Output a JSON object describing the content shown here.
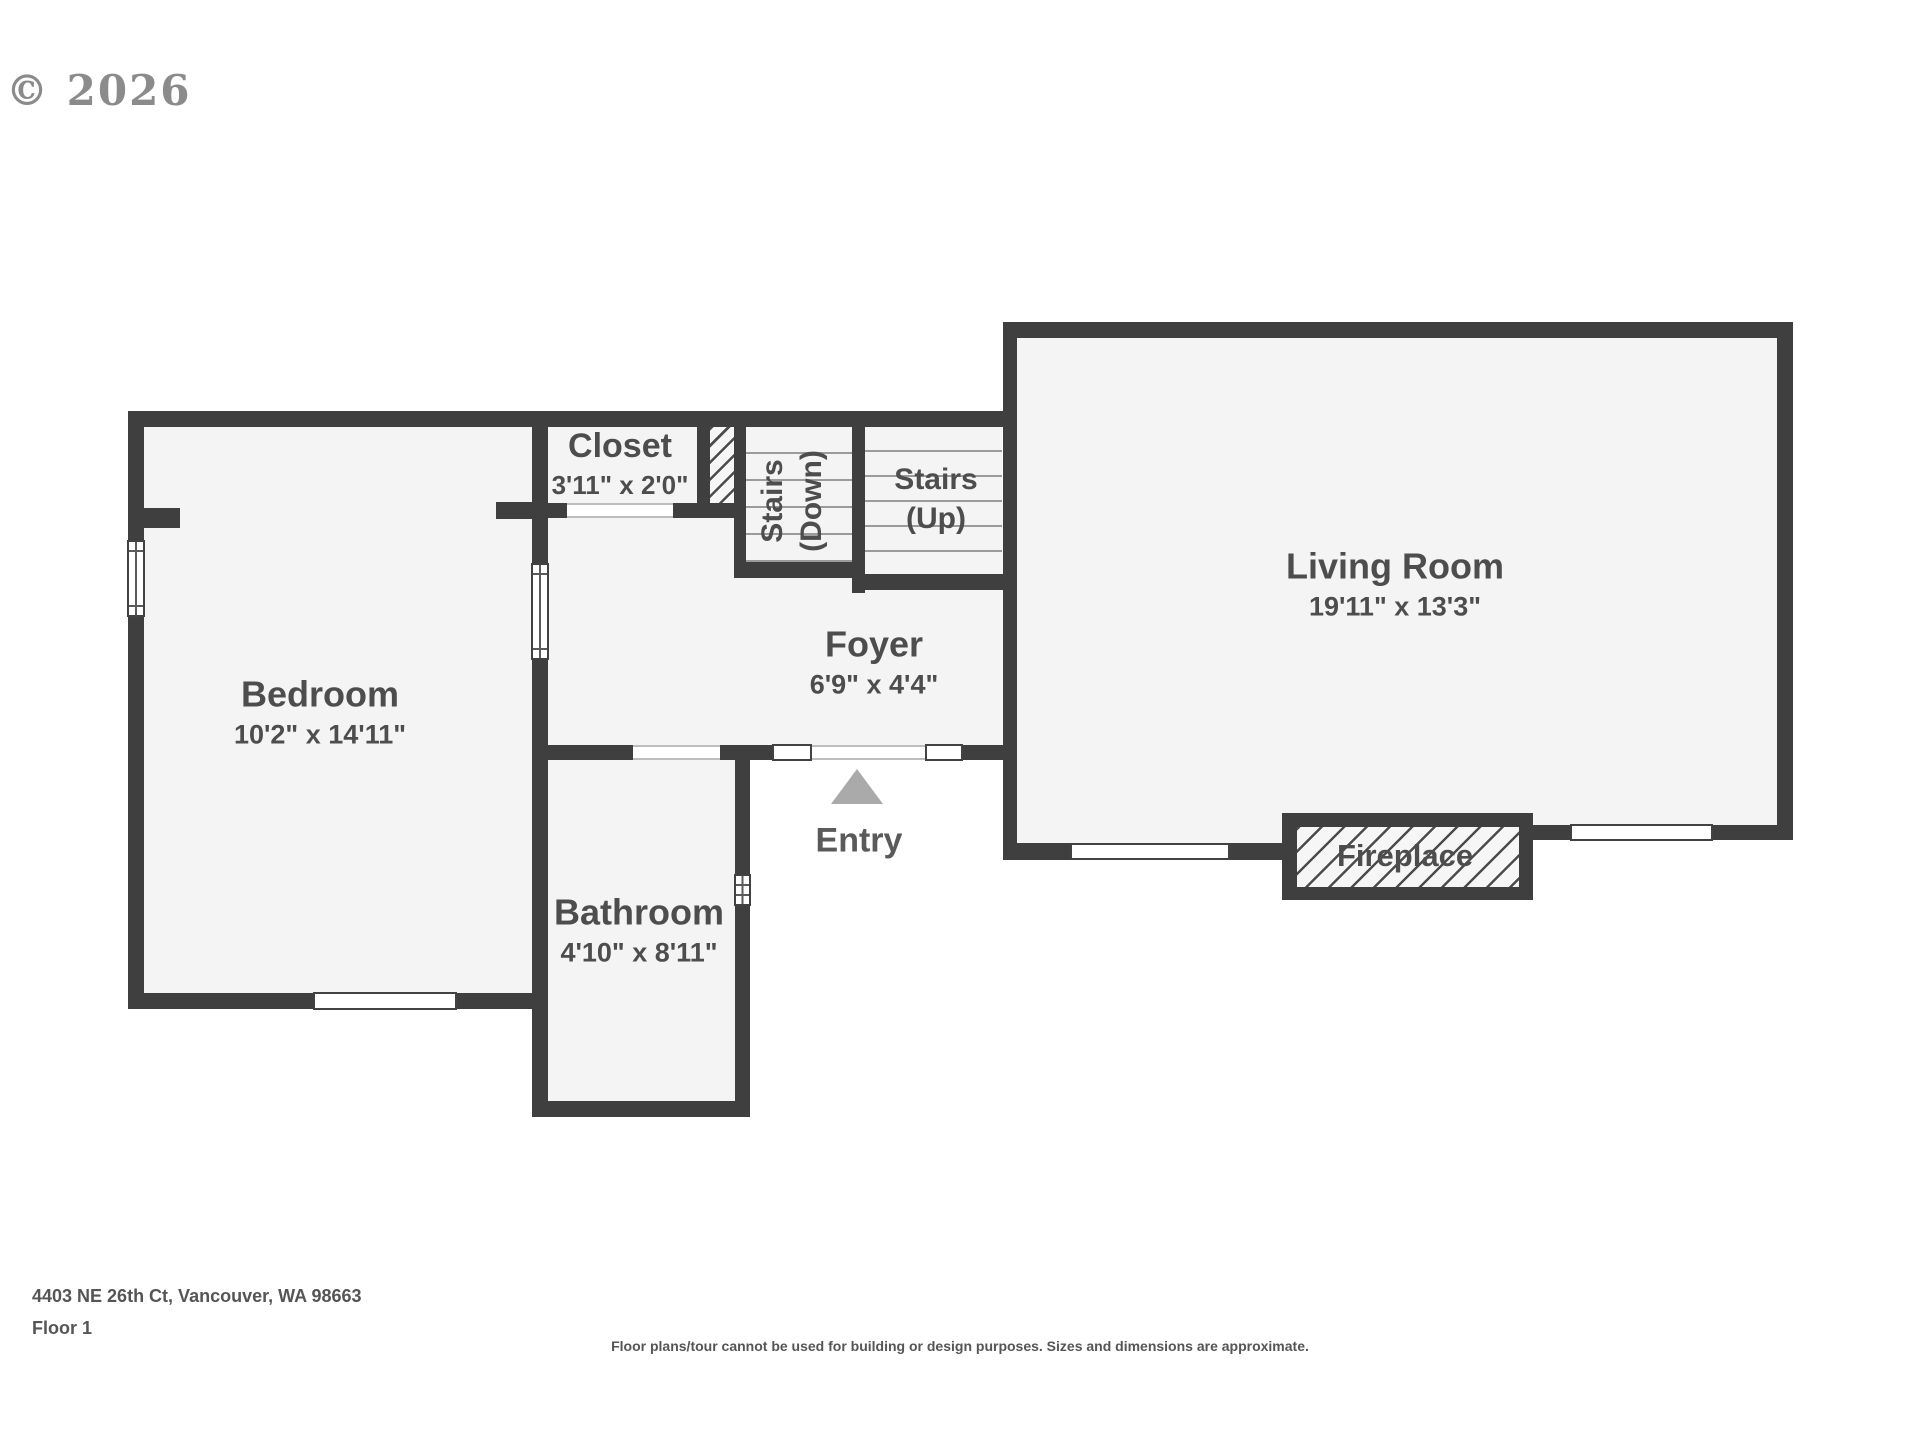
{
  "copyright": "© 2026",
  "rooms": {
    "bedroom": {
      "name": "Bedroom",
      "dims": "10'2\" x 14'11\""
    },
    "closet": {
      "name": "Closet",
      "dims": "3'11\" x 2'0\""
    },
    "stairs_down": {
      "line1": "Stairs",
      "line2": "(Down)"
    },
    "stairs_up": {
      "line1": "Stairs",
      "line2": "(Up)"
    },
    "foyer": {
      "name": "Foyer",
      "dims": "6'9\" x 4'4\""
    },
    "living_room": {
      "name": "Living Room",
      "dims": "19'11\" x 13'3\""
    },
    "bathroom": {
      "name": "Bathroom",
      "dims": "4'10\" x 8'11\""
    },
    "fireplace": {
      "name": "Fireplace"
    },
    "entry": {
      "name": "Entry"
    }
  },
  "footer": {
    "address": "4403 NE 26th Ct, Vancouver, WA 98663",
    "floor": "Floor 1",
    "disclaimer": "Floor plans/tour cannot be used for building or design purposes. Sizes and dimensions are approximate."
  },
  "colors": {
    "wall": "#3f3f3f",
    "floor": "#f4f4f4",
    "label_text": "#4d4d4d",
    "entry_arrow": "#aaaaaa"
  }
}
